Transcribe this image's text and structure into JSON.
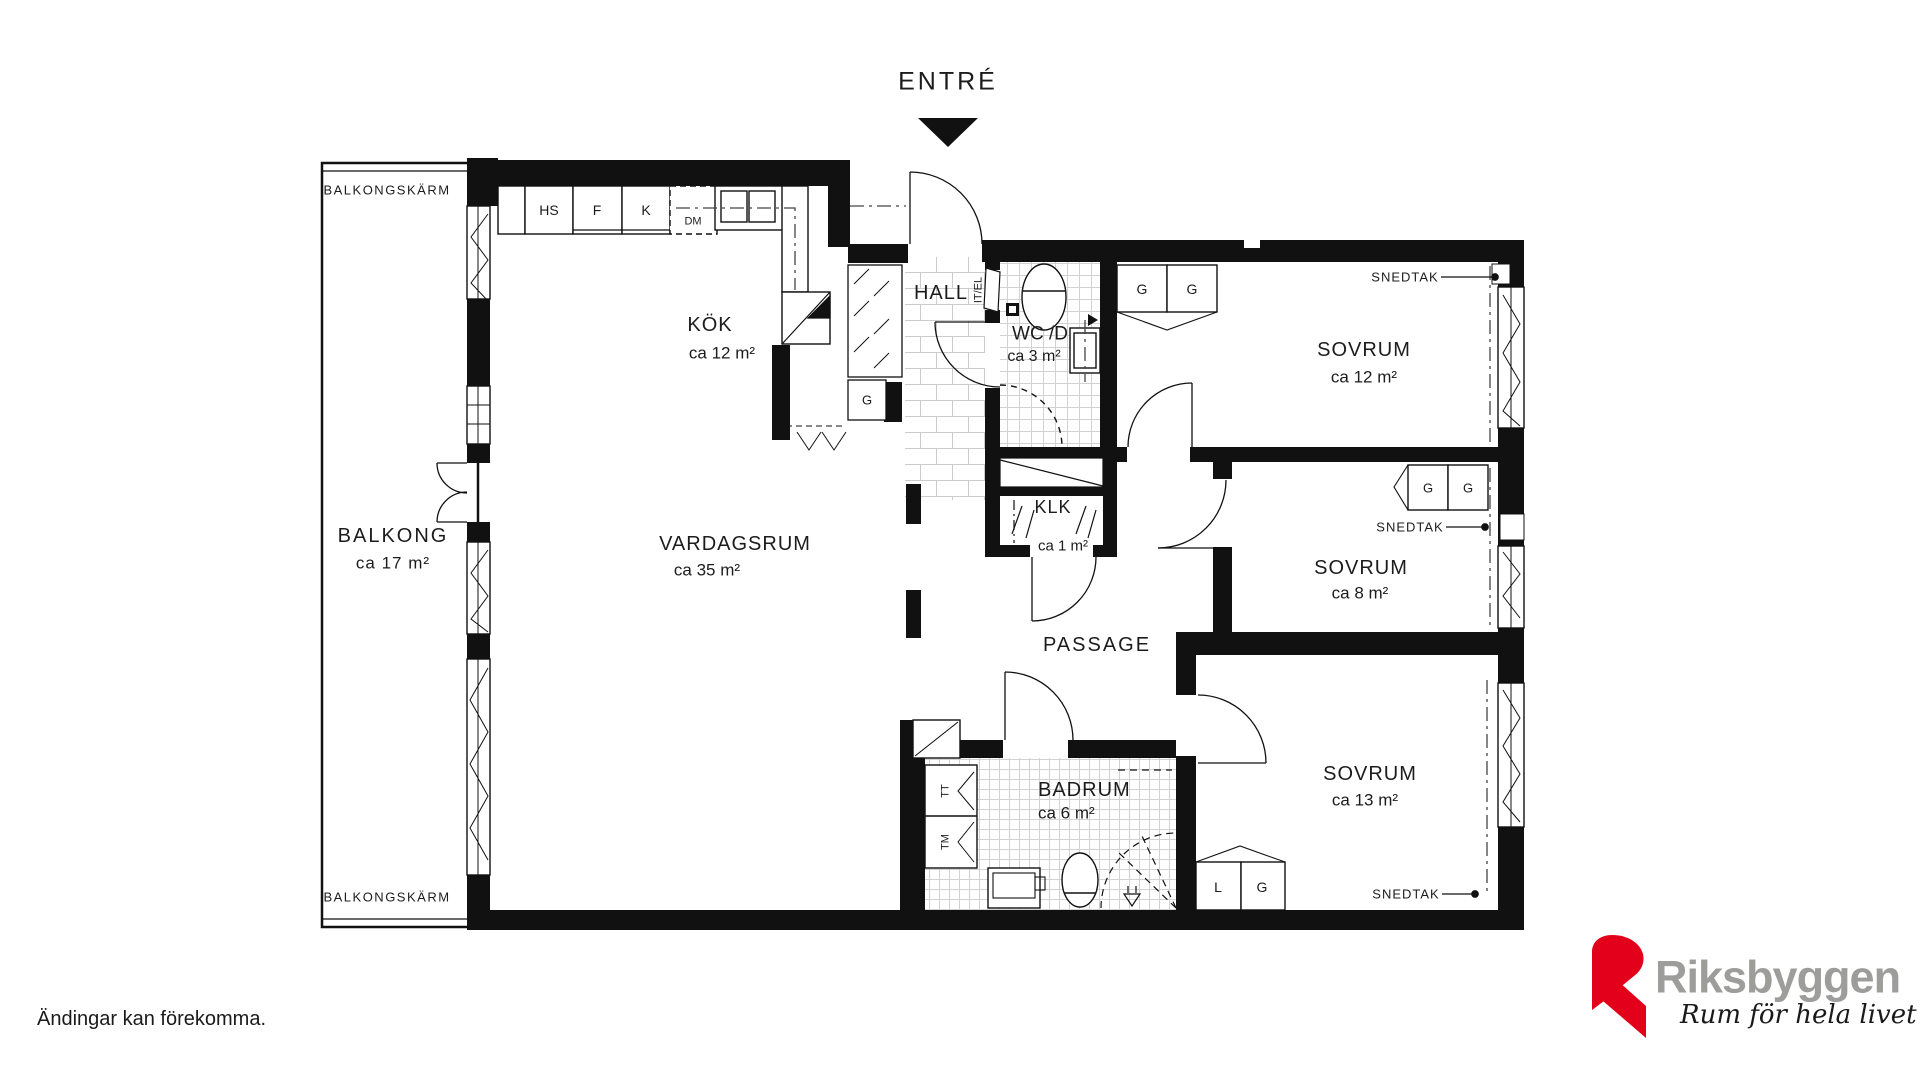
{
  "plan": {
    "entry": {
      "label": "ENTRÉ"
    },
    "balcony": {
      "screen_label": "BALKONGSKÄRM",
      "name": "BALKONG",
      "area": "ca 17 m²"
    },
    "rooms": {
      "kok": {
        "name": "KÖK",
        "area": "ca 12 m²"
      },
      "vardagsrum": {
        "name": "VARDAGSRUM",
        "area": "ca 35 m²"
      },
      "hall": {
        "name": "HALL"
      },
      "wc": {
        "name": "WC /D",
        "area": "ca 3 m²"
      },
      "klk": {
        "name": "KLK",
        "area": "ca 1 m²"
      },
      "passage": {
        "name": "PASSAGE"
      },
      "badrum": {
        "name": "BADRUM",
        "area": "ca 6 m²"
      },
      "sovrum_stor": {
        "name": "SOVRUM",
        "area": "ca 12 m²"
      },
      "sovrum_mellan": {
        "name": "SOVRUM",
        "area": "ca 8 m²"
      },
      "sovrum_liten": {
        "name": "SOVRUM",
        "area": "ca 13 m²"
      }
    },
    "fixtures": {
      "hs": "HS",
      "fridge": "F",
      "freezer": "K",
      "dm": "DM",
      "garderob": "G",
      "linne": "L",
      "tt": "TT",
      "tm": "TM",
      "it_el": "IT/EL"
    },
    "snedtak_label": "SNEDTAK",
    "line_color": "#111111"
  },
  "footer": {
    "disclaimer": "Ändingar kan förekomma."
  },
  "logo": {
    "brand": "Riksbyggen",
    "tagline": "Rum för hela livet",
    "brand_color": "#9d9d9c",
    "accent_color": "#e2001a"
  }
}
